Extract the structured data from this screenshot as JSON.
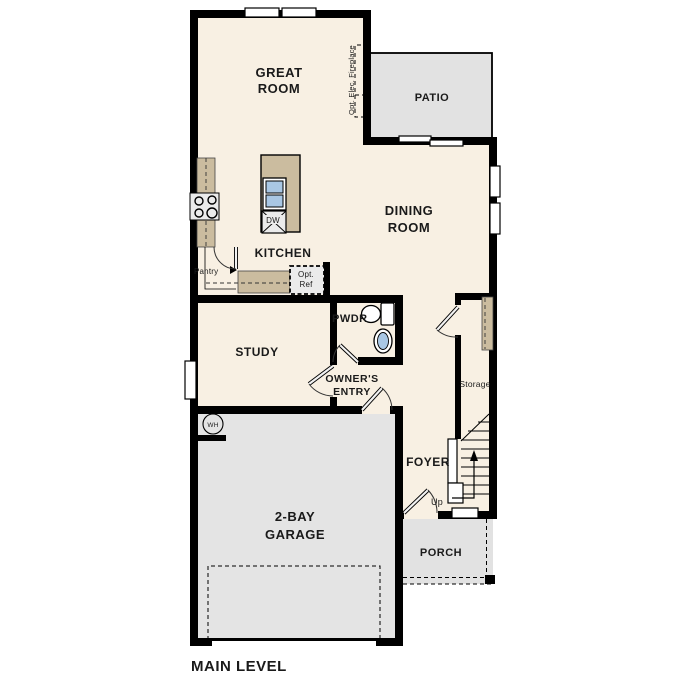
{
  "title": "MAIN LEVEL",
  "rooms": {
    "great_room_1": "GREAT",
    "great_room_2": "ROOM",
    "patio": "PATIO",
    "dining_1": "DINING",
    "dining_2": "ROOM",
    "kitchen": "KITCHEN",
    "study": "STUDY",
    "pwdr": "PWDR",
    "owners_entry_1": "OWNER'S",
    "owners_entry_2": "ENTRY",
    "foyer": "FOYER",
    "garage_1": "2-BAY",
    "garage_2": "GARAGE",
    "porch": "PORCH",
    "storage": "Storage"
  },
  "fixtures": {
    "pantry": "Pantry",
    "opt_ref_1": "Opt.",
    "opt_ref_2": "Ref",
    "dishwasher": "DW",
    "water_heater": "WH",
    "fireplace": "Opt. Elec. Fireplace",
    "stairs_up": "Up"
  },
  "colors": {
    "floor": "#F8F0E3",
    "patio": "#E2E2E2",
    "garage": "#E4E4E4",
    "porch": "#E2E2E2",
    "counter": "#CBBC9F",
    "appliance": "#EBEBEB",
    "sink": "#A9C7E4",
    "wall": "#000000"
  }
}
